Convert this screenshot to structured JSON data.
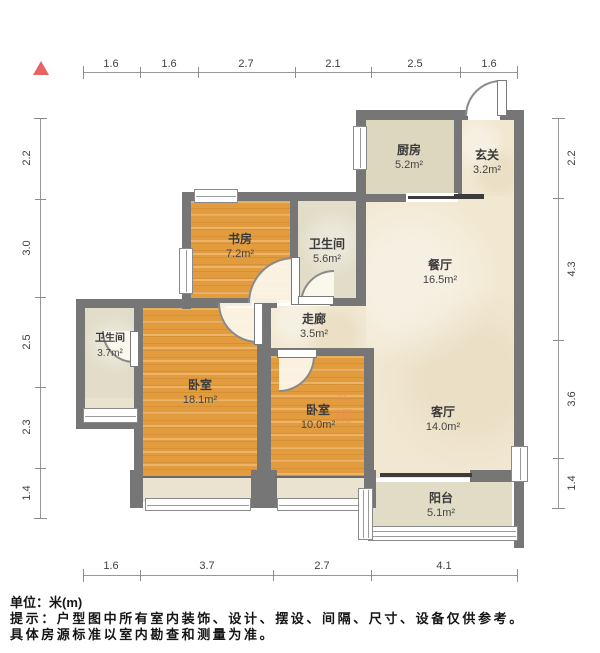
{
  "rooms": {
    "kitchen": {
      "name": "厨房",
      "area": "5.2m²"
    },
    "entry": {
      "name": "玄关",
      "area": "3.2m²"
    },
    "study": {
      "name": "书房",
      "area": "7.2m²"
    },
    "bath_main": {
      "name": "卫生间",
      "area": "5.6m²"
    },
    "dining": {
      "name": "餐厅",
      "area": "16.5m²"
    },
    "bath_small": {
      "name": "卫生间",
      "area": "3.7m²"
    },
    "corridor": {
      "name": "走廊",
      "area": "3.5m²"
    },
    "bedroom_master": {
      "name": "卧室",
      "area": "18.1m²"
    },
    "bedroom_second": {
      "name": "卧室",
      "area": "10.0m²"
    },
    "living": {
      "name": "客厅",
      "area": "14.0m²"
    },
    "balcony": {
      "name": "阳台",
      "area": "5.1m²"
    }
  },
  "dimensions": {
    "top": [
      "1.6",
      "1.6",
      "2.7",
      "2.1",
      "2.5",
      "1.6"
    ],
    "bottom": [
      "1.6",
      "3.7",
      "2.7",
      "4.1"
    ],
    "left": [
      "2.2",
      "3.0",
      "2.5",
      "2.3",
      "1.4"
    ],
    "right": [
      "2.2",
      "4.3",
      "3.6",
      "1.4"
    ]
  },
  "footer": {
    "unit": "单位：米(m)",
    "note1": "提示：户型图中所有室内装饰、设计、摆设、间隔、尺寸、设备仅供参考。",
    "note2": "具体房源标准以室内勘查和测量为准。"
  },
  "watermark": {
    "text": "正顺"
  },
  "colors": {
    "wall": "#767676",
    "wood_floor": "#e39c3d",
    "beige_floor": "#f2e8d2",
    "kitchen_floor": "#ddd7c0",
    "bath_floor": "#e2ddc9",
    "balcony_floor": "#e1dcc6",
    "north_arrow": "#e86262",
    "dimension_text": "#3f3f3f"
  }
}
